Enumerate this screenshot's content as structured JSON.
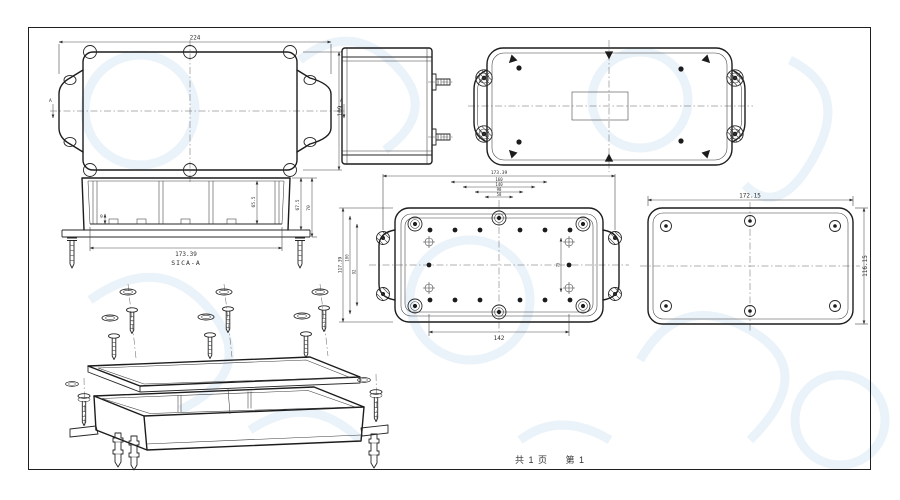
{
  "page": {
    "footer_total": "共 1 页",
    "footer_page": "第 1"
  },
  "views": {
    "cover_outside": {
      "dim_width": "224",
      "dim_height": "109",
      "section_label_left": "A",
      "section_label_right": "A"
    },
    "section_aa": {
      "label": "SICA-A",
      "dim_width": "173.39",
      "dim_depth_inner": "65.5",
      "dim_depth_mid": "67.5",
      "dim_depth_outer": "70",
      "dim_rib": "9"
    },
    "base_inside": {
      "dim_top": "173.39",
      "dim_stack": [
        "160",
        "140",
        "98",
        "58"
      ],
      "dim_bottom": "142",
      "dim_left_outer": "117.39",
      "dim_left_mid": "100",
      "dim_left_inner": "92",
      "dim_right": "75"
    },
    "cover_inside": {
      "dim_width": "172.15",
      "dim_height": "116.15"
    }
  }
}
